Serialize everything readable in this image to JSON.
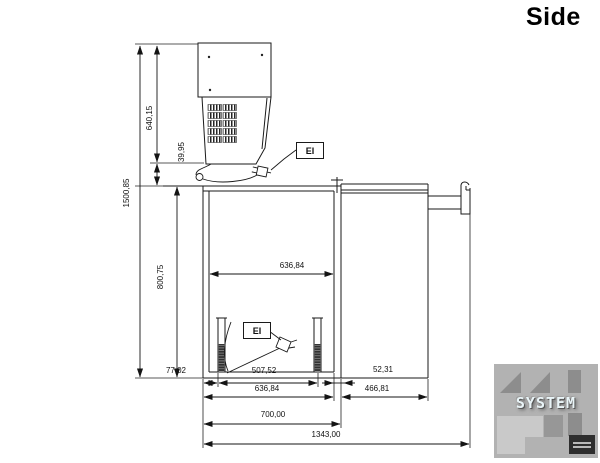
{
  "title": "Side",
  "annotations": {
    "electrical_top": "EI",
    "electrical_bottom": "EI"
  },
  "dimensions": {
    "head_height": "640,15",
    "gap_below_head": "39,95",
    "total_height": "1500,85",
    "bin_height": "800,75",
    "inner_width_top": "636,84",
    "foot_offset": "77,02",
    "rail_spacing": "507,52",
    "wall_offset": "52,31",
    "bin_width": "636,84",
    "right_section_width": "466,81",
    "depth": "700,00",
    "total_width": "1343,00"
  },
  "watermark": {
    "brand": "SYSTEM"
  },
  "colors": {
    "line": "#1a1a1a",
    "watermark_bg": "#b2b2b2",
    "watermark_text": "#e9f4f7",
    "watermark_shape": "#8d8d8d"
  }
}
